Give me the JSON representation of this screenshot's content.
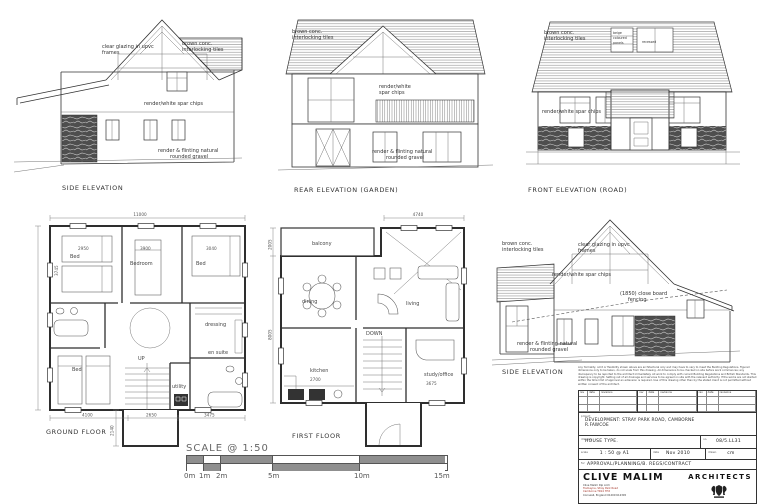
{
  "elevations": {
    "side1": {
      "label": "SIDE ELEVATION",
      "glazing1": "clear glazing in upvc",
      "glazing2": "frames",
      "roof1": "brown conc.",
      "roof2": "interlocking tiles",
      "wall": "render/white spar chips",
      "base1": "render & flinting natural",
      "base2": "rounded gravel"
    },
    "rear": {
      "label": "REAR ELEVATION (GARDEN)",
      "roof1": "brown conc.",
      "roof2": "interlocking tiles",
      "wall1": "render/white",
      "wall2": "spar chips",
      "base1": "render & flinting natural",
      "base2": "rounded gravel"
    },
    "front": {
      "label": "FRONT ELEVATION (ROAD)",
      "roof1": "brown conc.",
      "roof2": "interlocking tiles",
      "dormer1a": "beige",
      "dormer1b": "coloured",
      "dormer1c": "panels",
      "dormer2": "recessed",
      "wall": "render/white spar chips"
    },
    "side2": {
      "label": "SIDE ELEVATION",
      "roof1": "brown conc.",
      "roof2": "interlocking tiles",
      "glazing1": "clear glazing in upvc",
      "glazing2": "frames",
      "wall": "render/white spar chips",
      "fence1": "(1850) close board",
      "fence2": "fencing",
      "base1": "render & flinting natural",
      "base2": "rounded gravel"
    }
  },
  "plans": {
    "ground": {
      "label": "GROUND FLOOR",
      "overall": "11000",
      "w1": "2950",
      "w2": "3900",
      "w3": "3040",
      "d1": "3745",
      "b1": "4100",
      "b2": "2650",
      "b3": "3475",
      "porch": "2140",
      "rooms": {
        "bed1": "Bed",
        "bedroom": "Bedroom",
        "bed2": "Bed",
        "bed3": "Bed",
        "dressing": "dressing",
        "ensuite": "en suite",
        "utility": "utility",
        "up": "UP"
      }
    },
    "first": {
      "label": "FIRST FLOOR",
      "top": "4740",
      "left1": "2005",
      "left2": "8005",
      "k": "2700",
      "s": "3675",
      "rooms": {
        "balcony": "balcony",
        "dining": "dining",
        "living": "living",
        "kitchen": "kitchen",
        "study": "study/office",
        "down": "DOWN"
      }
    }
  },
  "scalebar": {
    "title": "SCALE @ 1:50",
    "ticks": [
      "0m",
      "1m",
      "2m",
      "5m",
      "10m",
      "15m"
    ]
  },
  "titleblock": {
    "notes": [
      "Any formality, omit or flexibility shown above are architectural only and may have to vary to meet the Building Regulations. Figured dimensions only to be taken, do not scale from this drawing.",
      "All dimensions to be checked on site before work commences; any discrepancy to be reported to the architect immediately. All work to comply with current Building Regulations and British Standards.",
      "This drawing is copyright. Setting out of all drainage and services to be agreed on site with the relevant authority. If the works are not started within the time limit of approval an extension is required.",
      "Use of this drawing other than by the stated client is not permitted without written consent of the architect."
    ],
    "rev_headers": [
      "rev",
      "date",
      "revisions"
    ],
    "project_label": "project",
    "project1": "DEVELOPMENT: STRAY PARK ROAD, CAMBORNE",
    "project2": "R.FAWCOE",
    "drawing_label": "drawing",
    "drawing": "HOUSE TYPE.",
    "no_label": "no.",
    "no": "08/5.LL31",
    "scale_label": "scale",
    "scale": "1 : 50 @ A1",
    "date_label": "date",
    "date": "Nov 2010",
    "drawn_label": "drawn",
    "drawn": "cm",
    "for_label": "for",
    "for": "APPROVAL/PLANNING/B. REGS/CONTRACT",
    "firm_name": "CLIVE MALIM",
    "firm_type": "ARCHITECTS",
    "addr1": "Clive Malim Dip Arch",
    "addr2": "Tremayne, Stray Park Road",
    "addr3": "Camborne TR14 7HX",
    "addr4": "Cornwall, England     01209 612345"
  }
}
